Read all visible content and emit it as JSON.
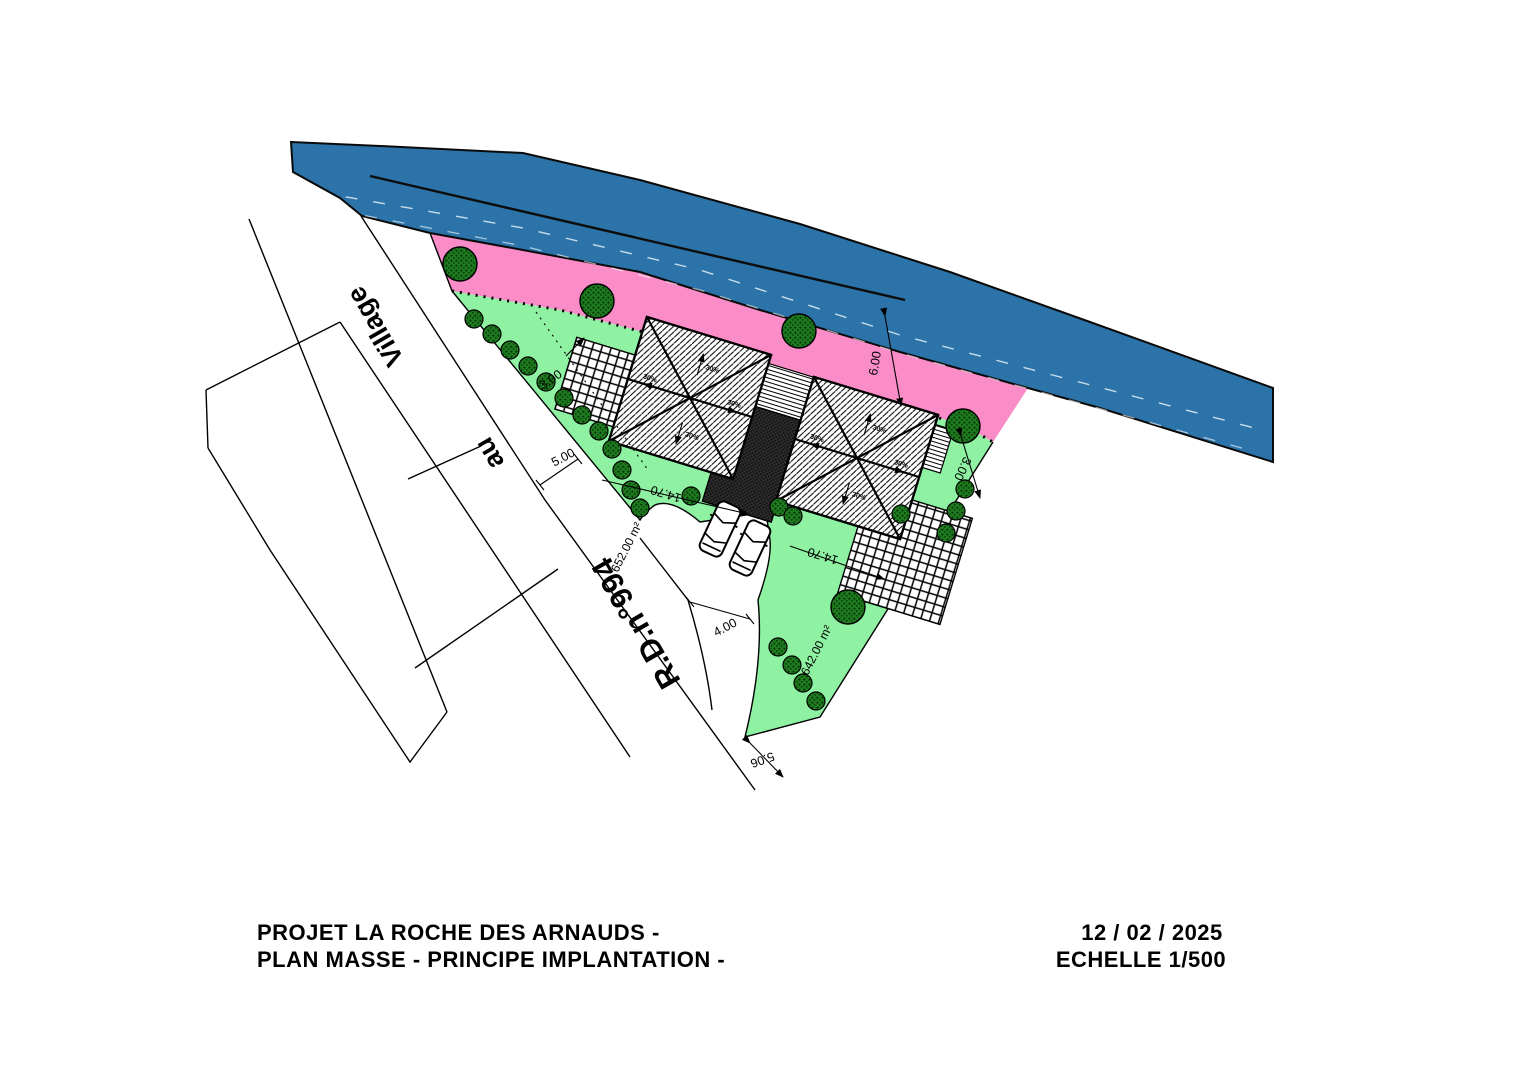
{
  "title_block": {
    "line1": "PROJET LA ROCHE DES ARNAUDS  -",
    "line2": "PLAN MASSE - PRINCIPE IMPLANTATION -",
    "date": "12 / 02 / 2025",
    "scale": "ECHELLE 1/500"
  },
  "roads": {
    "main_road_name": "R.D.n°994",
    "direction_word1": "au",
    "direction_word2": "Village"
  },
  "lots": {
    "left_area": "652.00 m²",
    "right_area": "642.00 m²"
  },
  "dimensions": {
    "road_setback": "5.00",
    "left_strip": "3.00",
    "river_setback": "6.00",
    "right_strip": "3.00",
    "house_width_left": "14.70",
    "house_width_right": "14.70",
    "access_width": "4.00",
    "access_frontage": "5.06"
  },
  "roof": {
    "slope_label": "30%"
  },
  "colors": {
    "asphalt_road": "#2B73A8",
    "setback_zone": "#FA8CC8",
    "garden": "#8FF2A3",
    "tree": "#1E7A1E"
  }
}
